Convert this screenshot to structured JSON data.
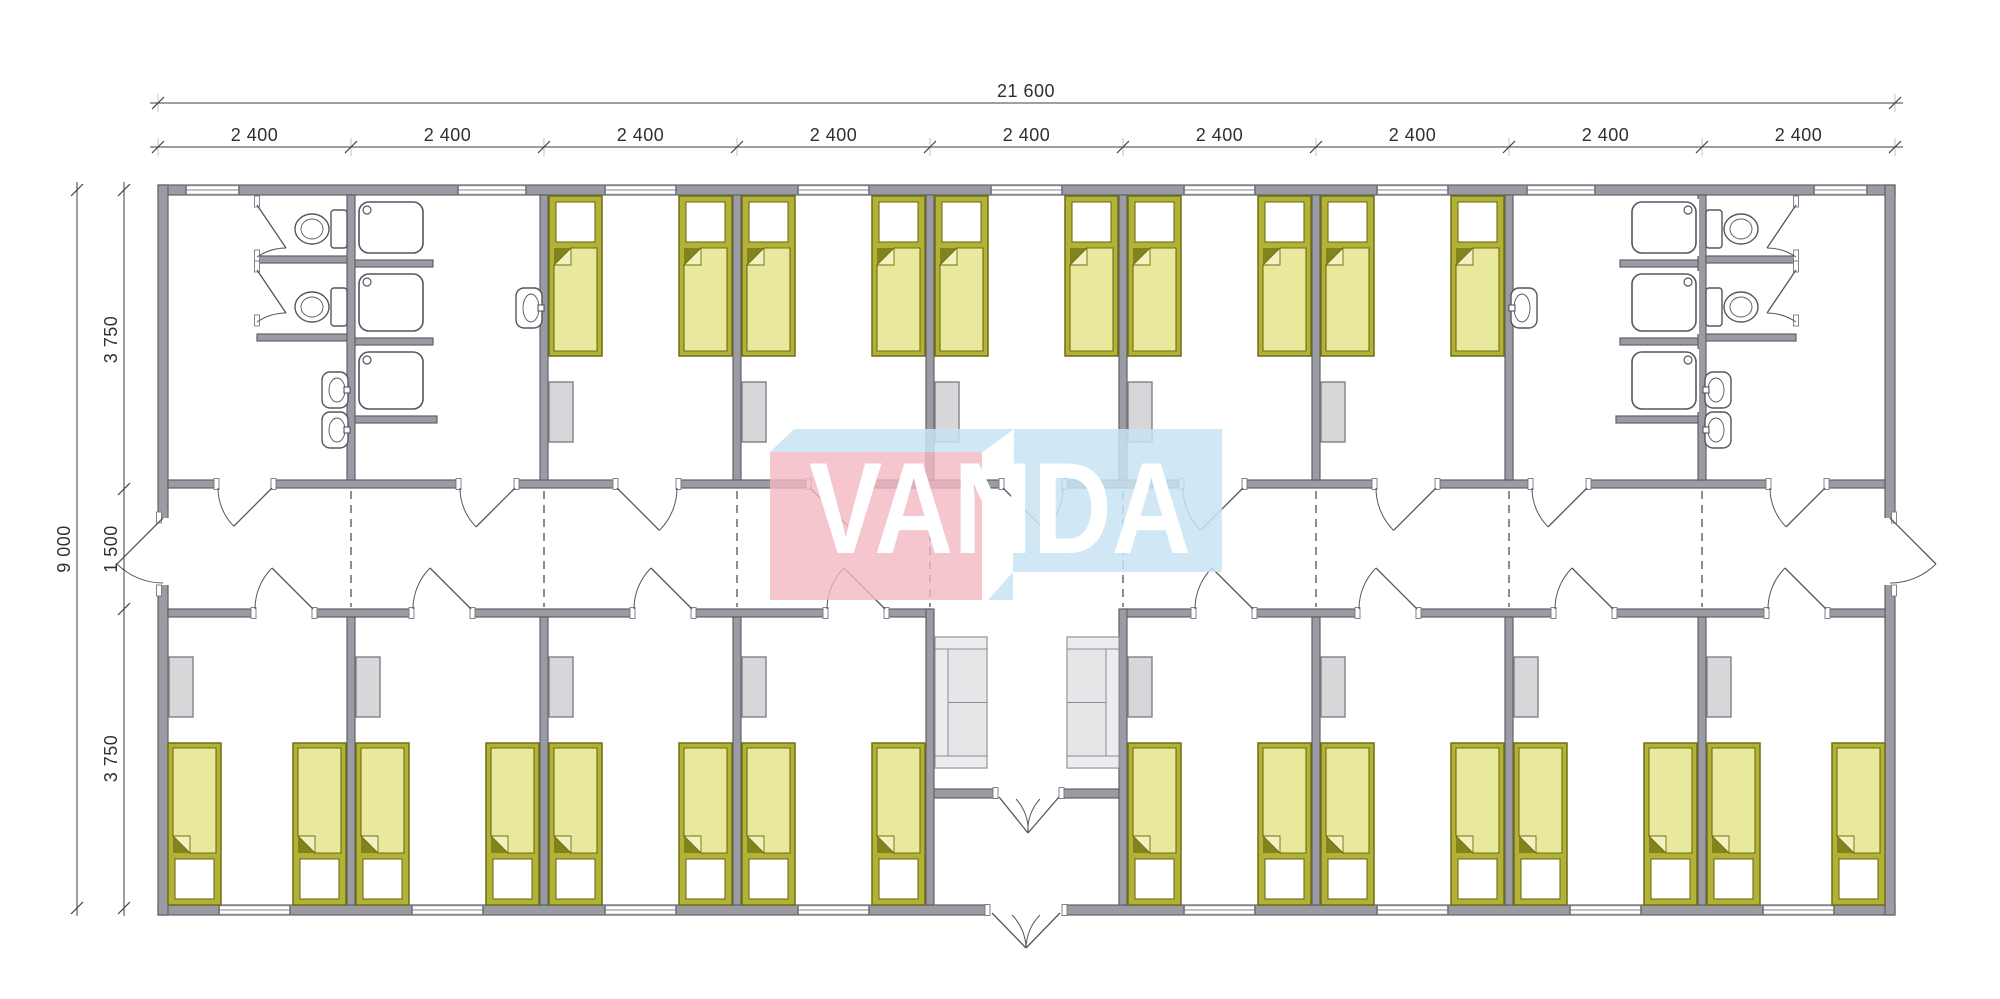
{
  "watermark": {
    "text": "VANDA",
    "pink": "#f2b8c2",
    "blue": "#c8e4f3"
  },
  "dimensions": {
    "top_total": "21 600",
    "top_segments": [
      "2 400",
      "2 400",
      "2 400",
      "2 400",
      "2 400",
      "2 400",
      "2 400",
      "2 400",
      "2 400"
    ],
    "side_total": "9 000",
    "side_segments": [
      "3 750",
      "1 500",
      "3 750"
    ]
  },
  "plan": {
    "colors": {
      "wall": "#9b9ba3",
      "wall_edge": "#60606a",
      "fixture_line": "#55555c",
      "bed_frame": "#b2b238",
      "bed_blanket": "#e9e99e",
      "bed_fold": "#83831e",
      "bed_flap": "#f2f2c0",
      "bed_outline": "#6e6e12",
      "furniture": "#d7d7d9",
      "furniture_edge": "#808088",
      "sofa": "#ececee",
      "sofa_edge": "#8c8c92",
      "dash": "#4d4d55"
    },
    "rows": {
      "top": [
        "wc-room",
        "shower-room",
        "bedroom",
        "bedroom",
        "bedroom",
        "bedroom",
        "bedroom",
        "shower-room",
        "wc-room"
      ],
      "middle": "corridor",
      "bottom": [
        "bedroom",
        "bedroom",
        "bedroom",
        "bedroom",
        "entrance-hall",
        "bedroom",
        "bedroom",
        "bedroom",
        "bedroom"
      ]
    },
    "fixture_counts": {
      "beds": 26,
      "wardrobes": 13,
      "showers": 6,
      "toilets": 4,
      "sinks": 6,
      "sofas": 2,
      "windows": 17
    }
  }
}
